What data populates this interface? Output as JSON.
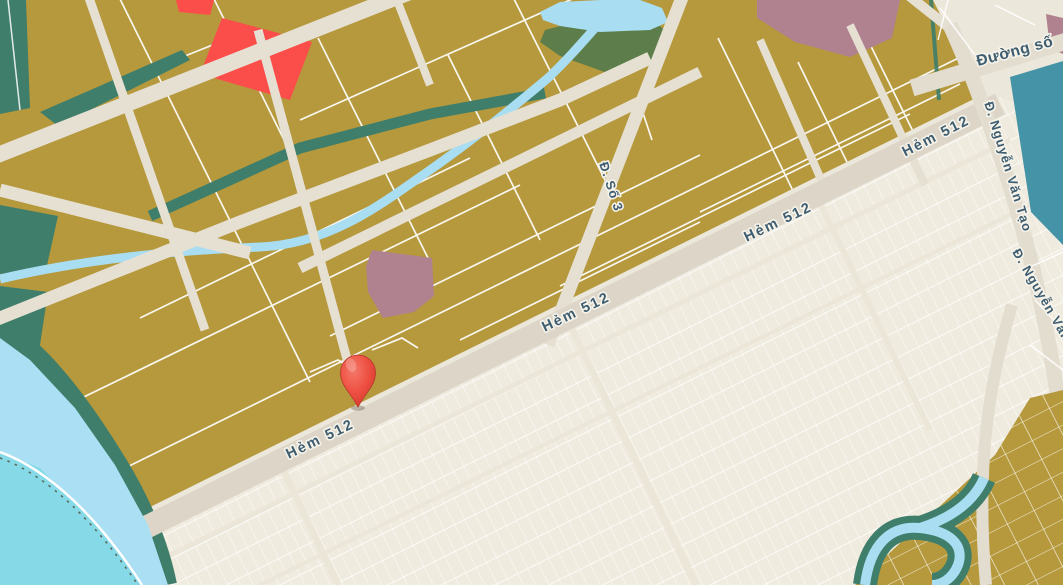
{
  "map": {
    "labels": [
      {
        "id": "hem-512-a",
        "text": "Hẻm 512"
      },
      {
        "id": "hem-512-b",
        "text": "Hẻm 512"
      },
      {
        "id": "hem-512-c",
        "text": "Hẻm 512"
      },
      {
        "id": "hem-512-d",
        "text": "Hẻm 512"
      },
      {
        "id": "d-so-3",
        "text": "Đ. Số 3"
      },
      {
        "id": "d-nguyen-van-tao-a",
        "text": "Đ. Nguyễn Văn Tạo"
      },
      {
        "id": "d-nguyen-van-tao-b",
        "text": "Đ. Nguyễn Văn"
      },
      {
        "id": "duong-so",
        "text": "Đường số"
      }
    ],
    "marker": {
      "icon": "map-pin-icon",
      "color": "#ee4e42"
    },
    "colors": {
      "background_cream": "#eee9dd",
      "road_cream": "#ded7c9",
      "land_parcel_olive": "#b6993d",
      "green_space_teal": "#3f7e6a",
      "green_space_moss": "#5d7e4a",
      "zone_red": "#fb4d49",
      "zone_mauve": "#b0818e",
      "water_light_blue": "#abdff3",
      "water_cyan": "#86dae7",
      "water_zone_teal_blue": "#4493a7",
      "parcel_line_white": "#ffffff",
      "label_text": "#3e5d70"
    }
  }
}
